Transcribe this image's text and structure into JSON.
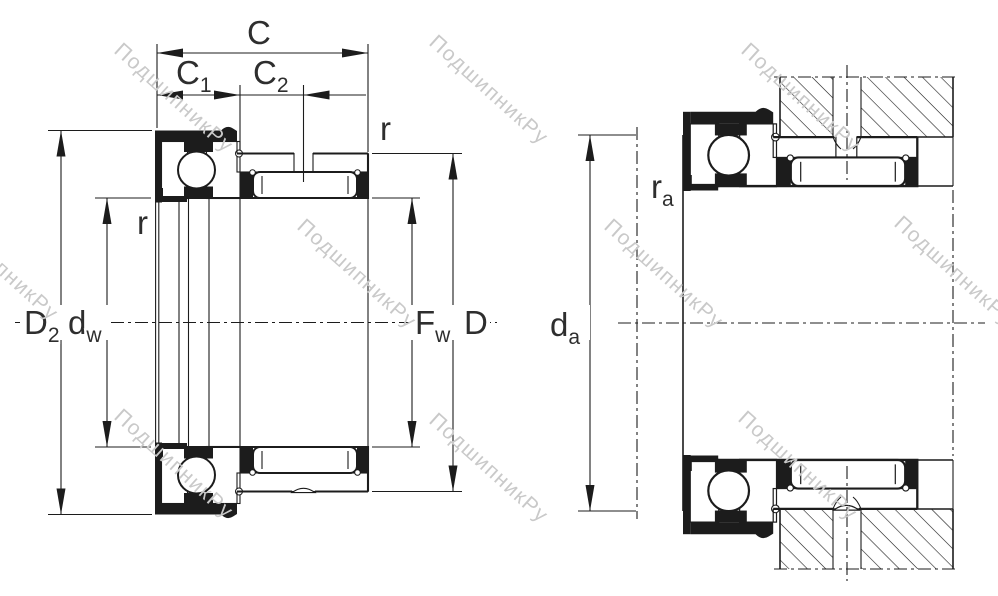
{
  "drawing": {
    "kind": "bearing-cross-section-technical-drawing",
    "views": {
      "left": "bearing dimensional cross-section",
      "right": "bearing mounted with shaft and housing"
    }
  },
  "labels": {
    "width_total": "C",
    "width_c1": {
      "main": "C",
      "sub": "1"
    },
    "width_c2": {
      "main": "C",
      "sub": "2"
    },
    "chamfer_od": "r",
    "chamfer_bore": "r",
    "flange_od": {
      "main": "D",
      "sub": "2"
    },
    "raceway_id": {
      "main": "d",
      "sub": "w"
    },
    "needle_id": {
      "main": "F",
      "sub": "w"
    },
    "outer_dia": "D",
    "shoulder_dia": {
      "main": "d",
      "sub": "a"
    },
    "mount_fillet": {
      "main": "r",
      "sub": "a"
    }
  },
  "watermark": {
    "text": "ПодшипникРу",
    "color": "#c9c9c9"
  },
  "colors": {
    "line": "#1c1c1c",
    "label": "#2e2e2e",
    "background": "#ffffff"
  }
}
